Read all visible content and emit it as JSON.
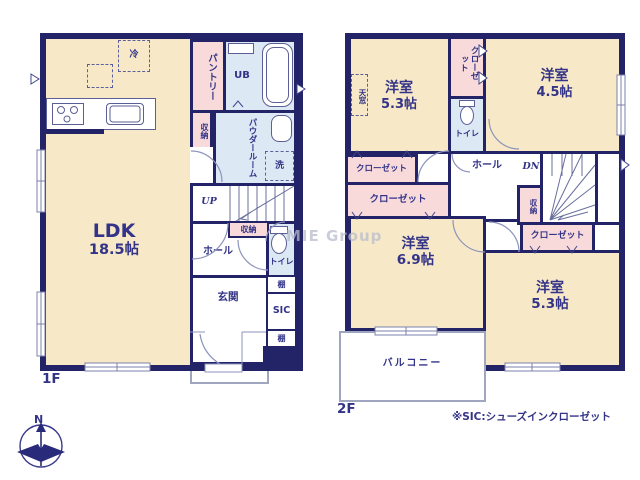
{
  "colors": {
    "wall": "#232368",
    "room_cream": "#f7e9c7",
    "closet_pink": "#f8dada",
    "wet_area_blue": "#dce8f4",
    "text": "#333388",
    "line": "#8d93bb"
  },
  "watermark": "MIE Group",
  "compass": {
    "north_label": "N"
  },
  "footnote": "※SIC:シューズインクローゼット",
  "floor1": {
    "label": "1F",
    "ldk": {
      "name": "LDK",
      "size": "18.5帖"
    },
    "fridge": "冷",
    "pantry": "パントリー",
    "unit_bath": "UB",
    "kitchen_storage": "収納",
    "powder_room": "パウダールーム",
    "laundry": "洗",
    "stairs": "UP",
    "hall": "ホール",
    "hall_storage": "収納",
    "toilet": "トイレ",
    "entrance": "玄関",
    "shelf_upper": "棚",
    "shoes_closet": "SIC",
    "shelf_lower": "棚"
  },
  "floor2": {
    "label": "2F",
    "skylight": "天窓",
    "bedroom_nw": {
      "name": "洋室",
      "size": "5.3帖"
    },
    "closet_top": "クローゼット",
    "toilet": "トイレ",
    "bedroom_ne": {
      "name": "洋室",
      "size": "4.5帖"
    },
    "hall": "ホール",
    "stairs": "DN",
    "storage": "収納",
    "closet_a": "クローゼット",
    "closet_b": "クローゼット",
    "closet_c": "クローゼット",
    "bedroom_sw": {
      "name": "洋室",
      "size": "6.9帖"
    },
    "bedroom_se": {
      "name": "洋室",
      "size": "5.3帖"
    },
    "balcony": "バルコニー"
  }
}
